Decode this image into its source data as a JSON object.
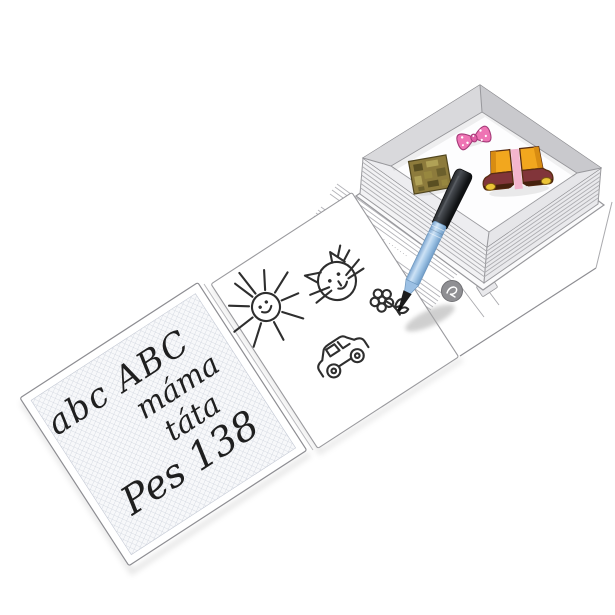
{
  "background_color": "#ffffff",
  "handwriting_panel": {
    "paper": "squared-grid",
    "lines": [
      {
        "text": "abc ABC"
      },
      {
        "text": "máma"
      },
      {
        "text": "táta"
      },
      {
        "text": "Pes 138"
      }
    ]
  },
  "drawing_panel": {
    "doodles": [
      "sun-doodle",
      "cat-doodle",
      "flower-doodle",
      "car-doodle"
    ]
  },
  "spine": {
    "text": "········ · ····· · ·······"
  },
  "box": {
    "shape": "book-shaped-tray",
    "items": [
      "pink-polka-dot-bow",
      "khaki-patch",
      "boots-sticker"
    ]
  },
  "pen": {
    "cap_color": "#1e2022",
    "barrel_color": "#a9cbe9",
    "tip_color": "#141414"
  },
  "colors": {
    "bow_pink": "#ee74b4",
    "boots_orange": "#f2a71e",
    "boots_brown": "#81353a",
    "buckle_yellow": "#ecc437",
    "patch_khaki": "#8d7b3c",
    "grid_line": "#ccd1db",
    "outline_gray": "#8d8d92",
    "wall_gray": "#d9d9dc"
  }
}
